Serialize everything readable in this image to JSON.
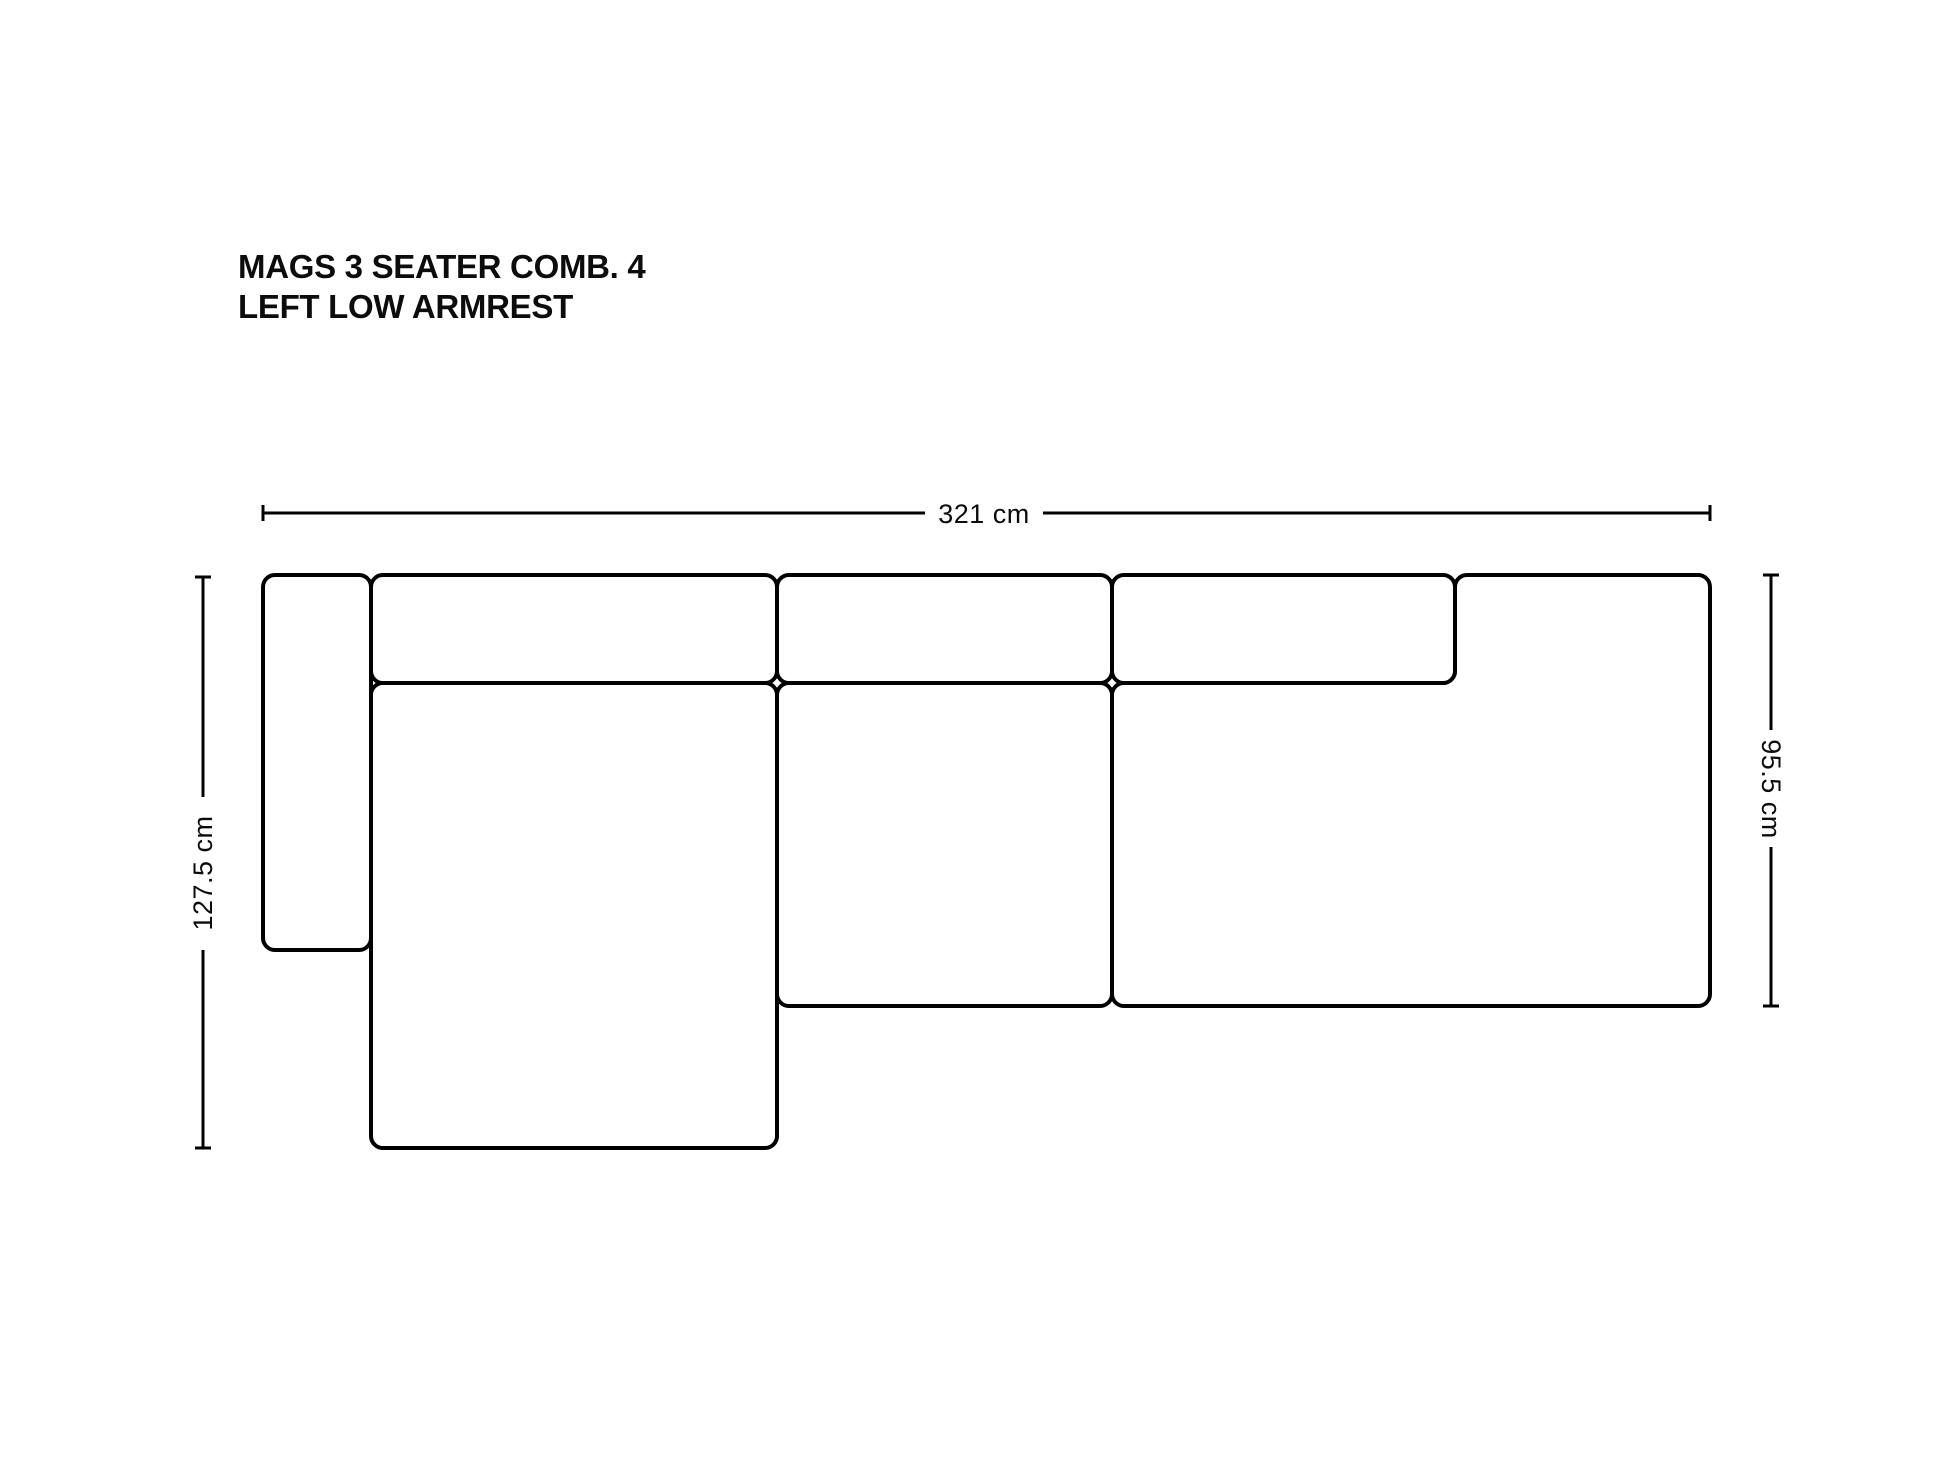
{
  "title": {
    "line1": "MAGS 3 SEATER COMB. 4",
    "line2": "LEFT LOW ARMREST"
  },
  "dimensions": {
    "overall_width": "321 cm",
    "overall_depth_left": "127.5 cm",
    "body_depth_right": "95.5 cm"
  },
  "colors": {
    "background": "#ffffff",
    "outline": "#000000",
    "text": "#0c0c0c"
  }
}
